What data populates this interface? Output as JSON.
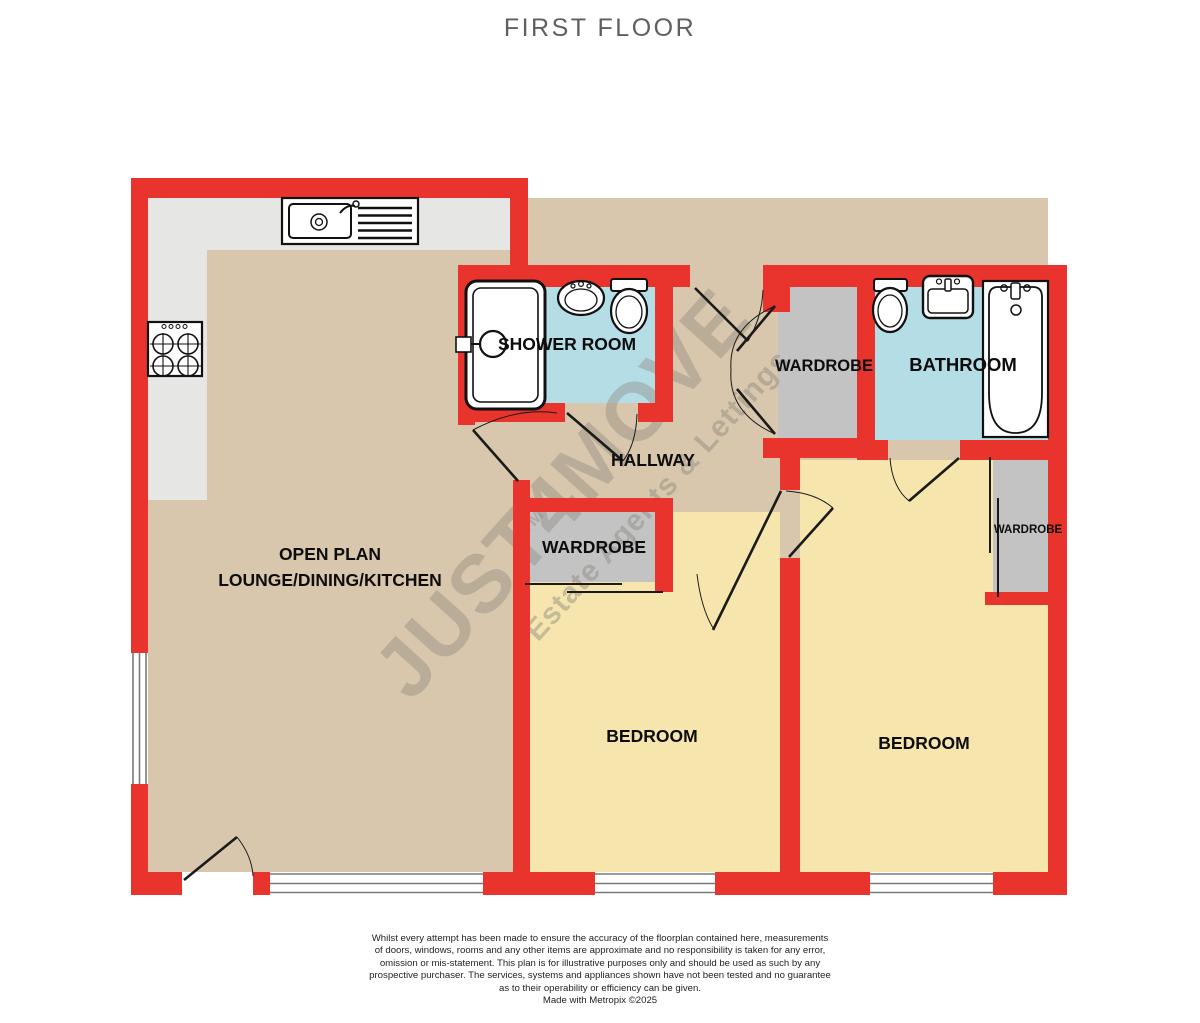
{
  "page": {
    "title": "FIRST FLOOR"
  },
  "colors": {
    "wall": "#e8342c",
    "floor_main": "#d8c7ac",
    "floor_bedroom": "#f6e6ad",
    "floor_bathroom": "#b5dde6",
    "floor_wardrobe": "#c3c3c3",
    "kitchen_counter": "#e6e6e4",
    "watermark_gray": "#8b887f",
    "title_gray": "#5f5f5f"
  },
  "rooms": {
    "open_plan": {
      "label_line1": "OPEN PLAN",
      "label_line2": "LOUNGE/DINING/KITCHEN"
    },
    "shower_room": {
      "label": "SHOWER ROOM"
    },
    "hallway": {
      "label": "HALLWAY"
    },
    "wardrobe_top": {
      "label": "WARDROBE"
    },
    "bathroom": {
      "label": "BATHROOM"
    },
    "wardrobe_mid": {
      "label": "WARDROBE"
    },
    "wardrobe_right": {
      "label": "WARDROBE"
    },
    "bedroom_1": {
      "label": "BEDROOM"
    },
    "bedroom_2": {
      "label": "BEDROOM"
    }
  },
  "fixtures": {
    "kitchen": [
      "sink-drainer-icon",
      "hob-icon"
    ],
    "shower_room": [
      "shower-enclosure-icon",
      "basin-icon",
      "toilet-icon"
    ],
    "bathroom": [
      "toilet-icon",
      "basin-icon",
      "bathtub-icon"
    ]
  },
  "watermark": {
    "brand": "JUST4MOVE",
    "trademark": "TM",
    "tagline": "Estate Agents & Lettings"
  },
  "disclaimer": {
    "lines": [
      "Whilst every attempt has been made to ensure the accuracy of the floorplan contained here, measurements",
      "of doors, windows, rooms and any other items are approximate and no responsibility is taken for any error,",
      "omission or mis-statement. This plan is for illustrative purposes only and should be used as such by any",
      "prospective purchaser. The services, systems and appliances shown have not been tested and no guarantee",
      "as to their operability or efficiency can be given.",
      "Made with Metropix ©2025"
    ]
  }
}
